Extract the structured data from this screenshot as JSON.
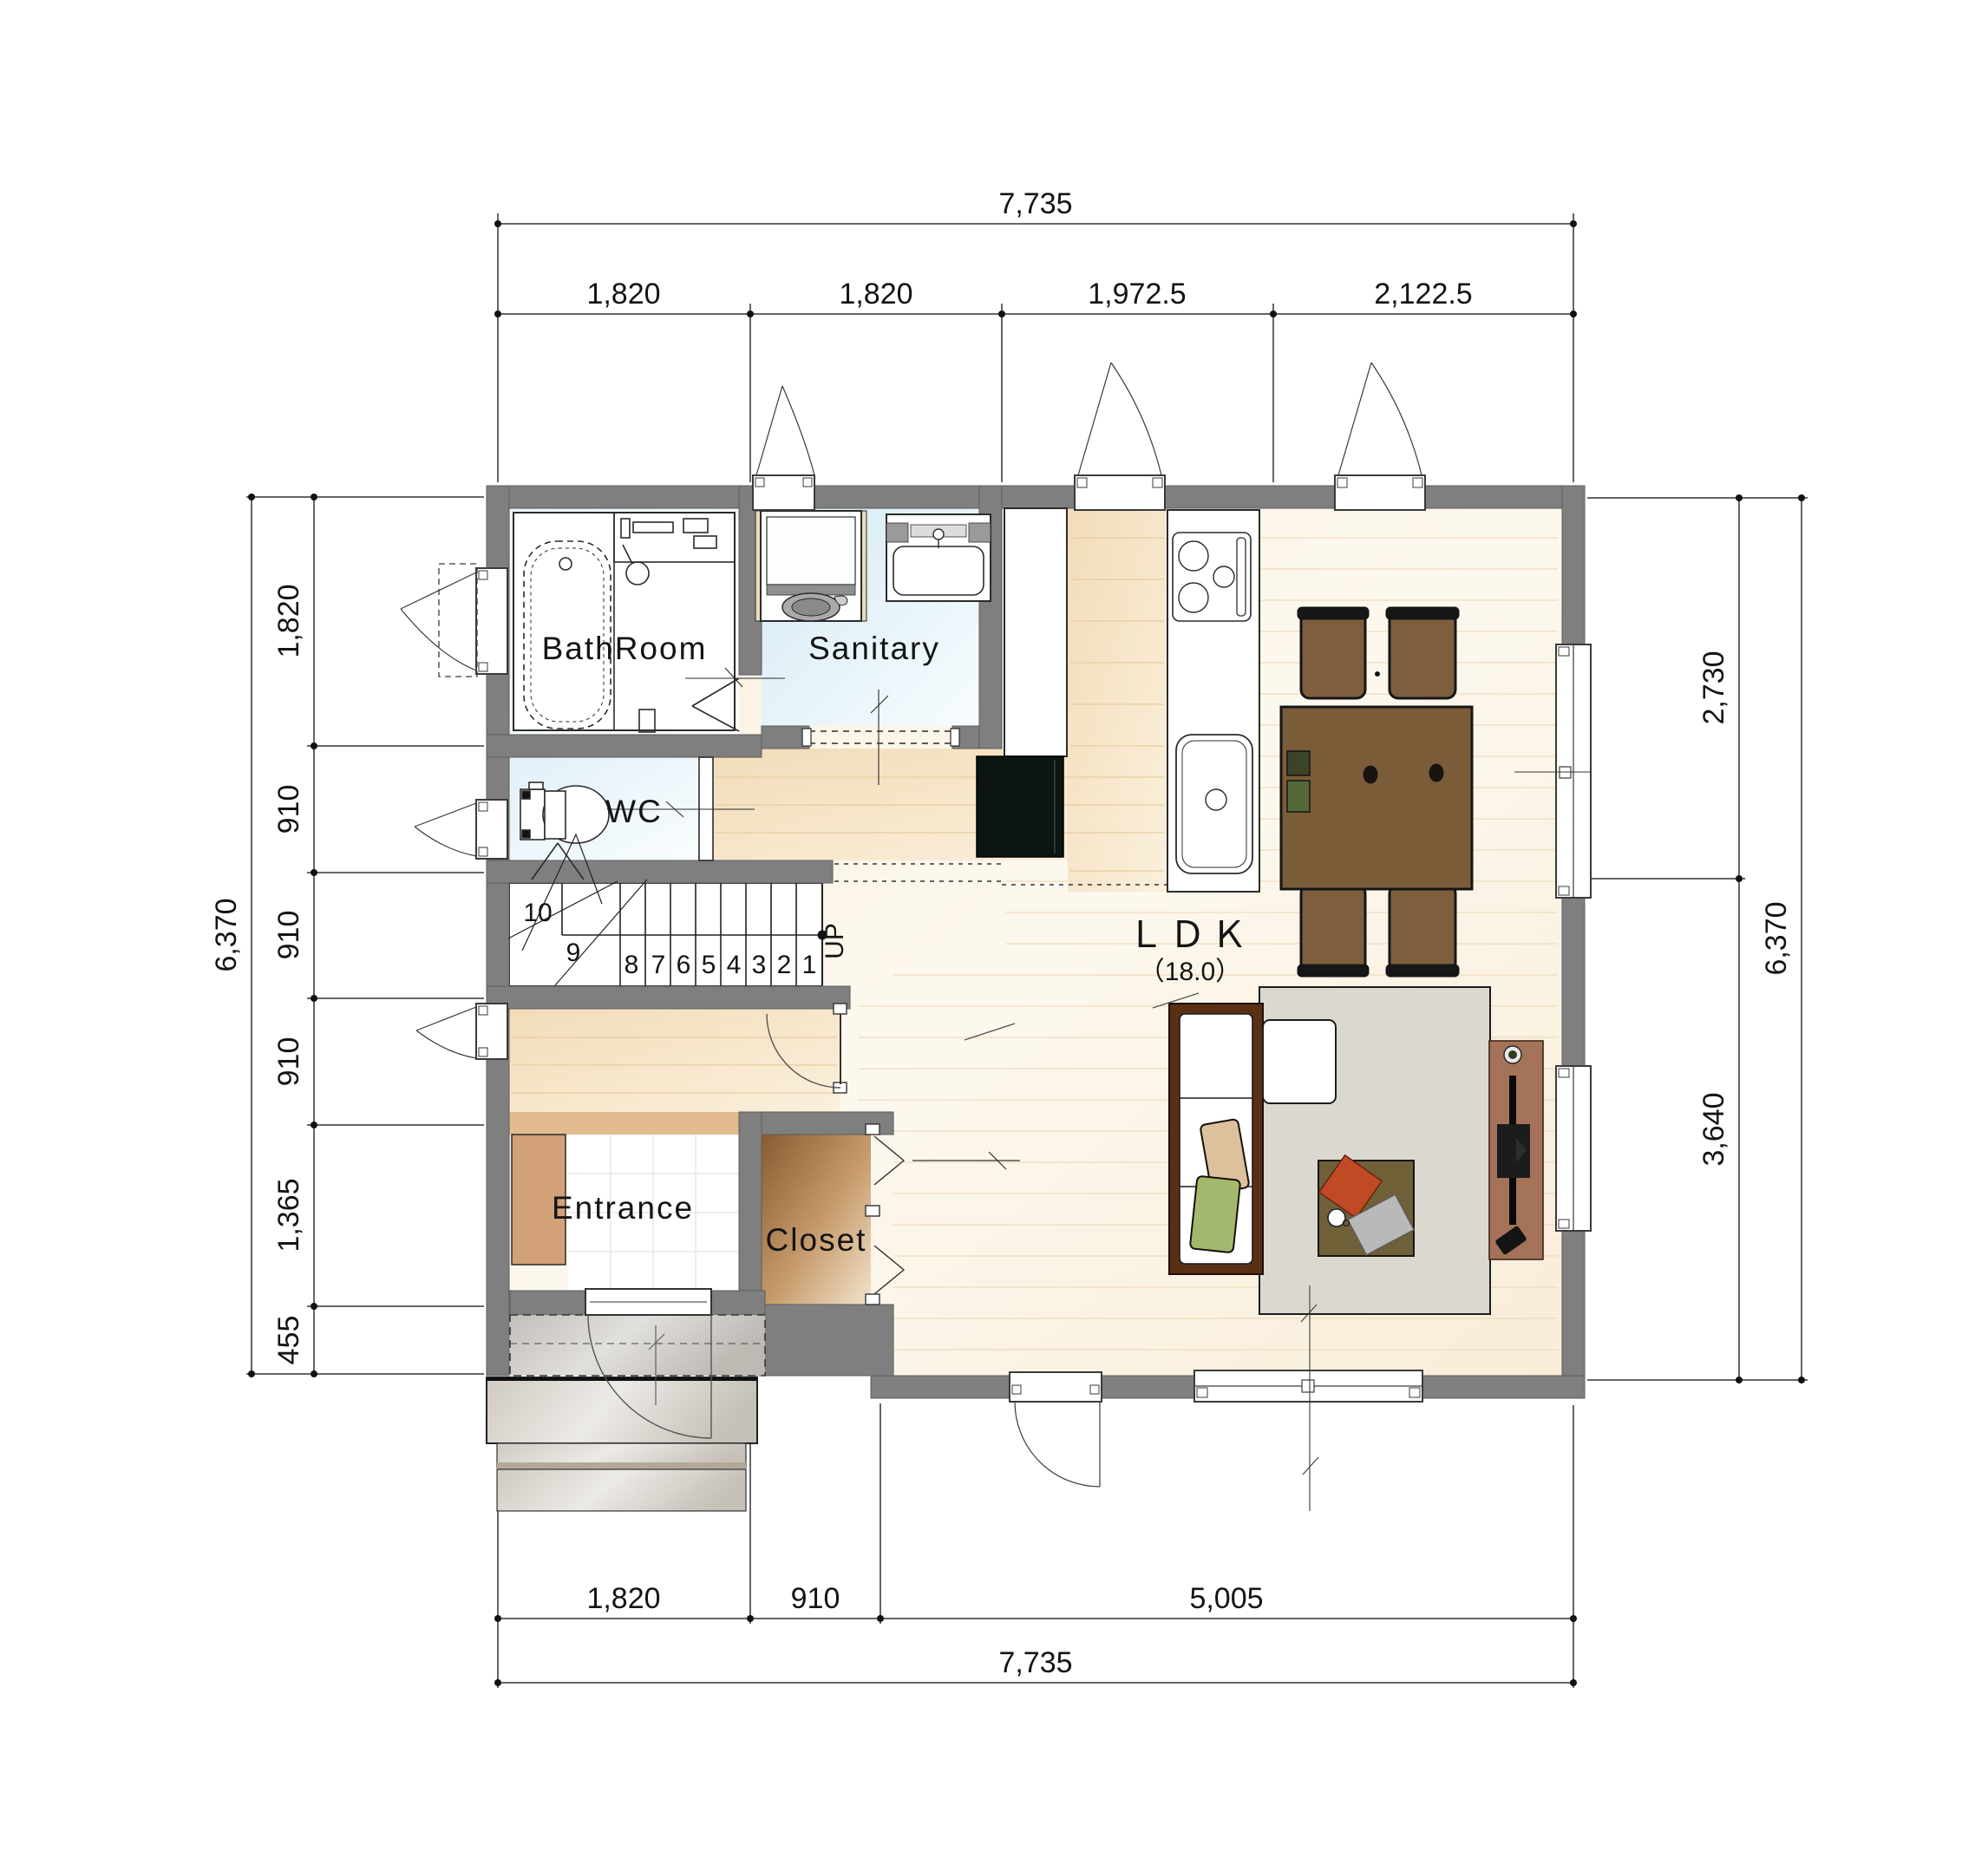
{
  "plan": {
    "rooms": {
      "bathroom": "BathRoom",
      "sanitary": "Sanitary",
      "wc": "WC",
      "entrance": "Entrance",
      "closet": "Closet",
      "ldk": "ＬＤＫ",
      "ldk_size": "（18.0）"
    },
    "stairs": {
      "numbers": [
        "1",
        "2",
        "3",
        "4",
        "5",
        "6",
        "7",
        "8",
        "9",
        "10"
      ],
      "up_label": "UP"
    },
    "dimensions": {
      "top": {
        "total": "7,735",
        "segments": [
          "1,820",
          "1,820",
          "1,972.5",
          "2,122.5"
        ]
      },
      "bottom": {
        "total": "7,735",
        "segments": [
          "1,820",
          "910",
          "5,005"
        ]
      },
      "left": {
        "total": "6,370",
        "segments": [
          "1,820",
          "910",
          "910",
          "910",
          "1,365",
          "455"
        ]
      },
      "right": {
        "total": "6,370",
        "segments": [
          "2,730",
          "3,640"
        ]
      }
    },
    "colors": {
      "wall": "#7f7f7f",
      "wet_room_floor": "#ddeef6",
      "hall_wood_floor": "#f6e3c6",
      "ldk_wood_floor": "#fbf3e4",
      "closet_wood": "#b98a55",
      "table_wood": "#7b5c39",
      "sofa_frame": "#5a3014",
      "rug": "#dbd8d0",
      "accent_cushion": "#c04a24"
    }
  }
}
